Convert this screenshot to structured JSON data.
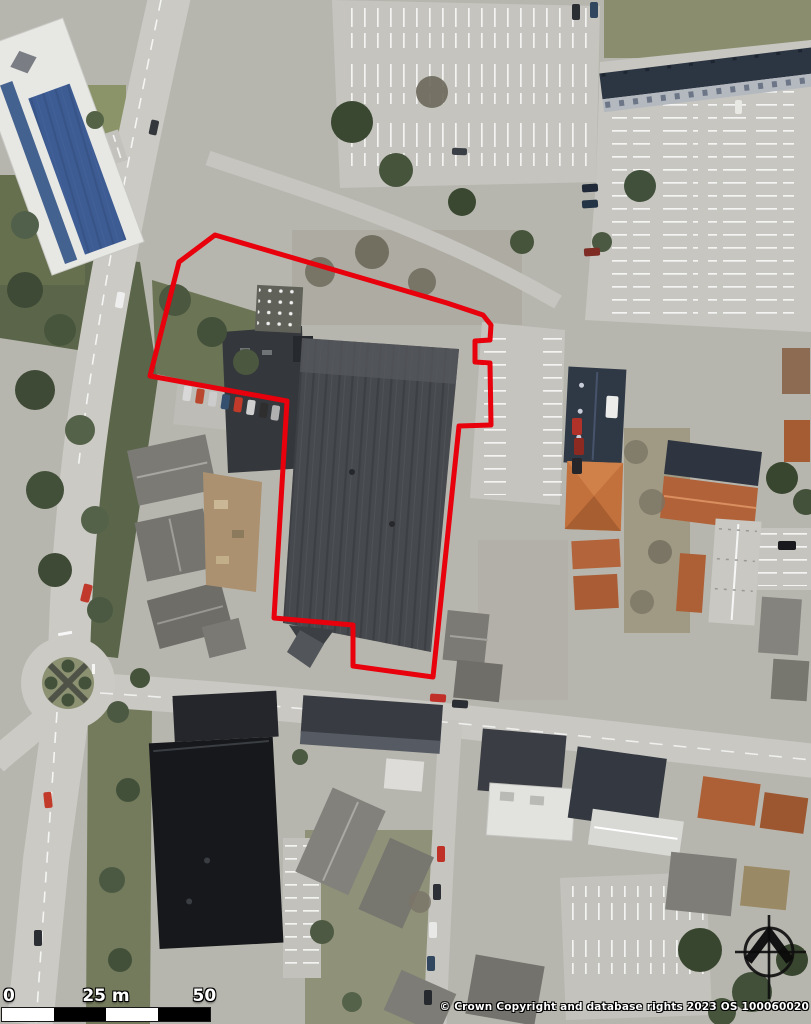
{
  "map": {
    "kind": "aerial-photograph",
    "site_boundary": {
      "color": "#e8000c",
      "stroke_width": 5,
      "points": "215,235 447,303 483,315 491,325 490,340 475,341 475,362 490,363 491,425 459,426 433,677 353,666 353,625 274,618 287,401 150,376 179,262"
    }
  },
  "scale_bar": {
    "labels": [
      "0",
      "25 m",
      "50 m"
    ],
    "segment_colors": [
      "#ffffff",
      "#000000",
      "#ffffff",
      "#000000"
    ]
  },
  "attribution": {
    "text": "© Crown Copyright and database rights 2023 OS 100060020"
  },
  "north_arrow": {
    "icon": "compass-crosshair-north"
  }
}
